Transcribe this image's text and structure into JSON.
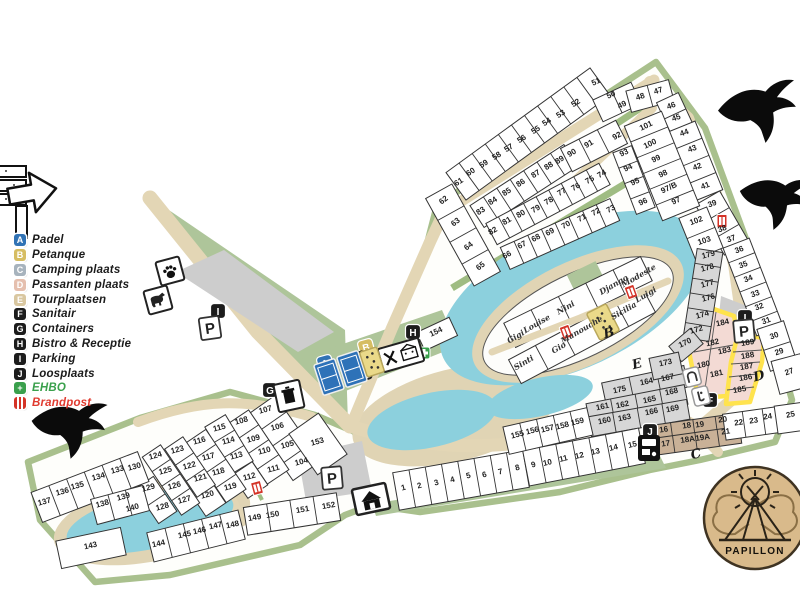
{
  "logo": {
    "text": "PAPILLON"
  },
  "legend": {
    "items": [
      {
        "letter": "A",
        "label": "Padel",
        "color": "#3173b5",
        "text_color": "#1b1b1b"
      },
      {
        "letter": "B",
        "label": "Petanque",
        "color": "#d6bd62",
        "text_color": "#1b1b1b"
      },
      {
        "letter": "C",
        "label": "Camping plaats",
        "color": "#a7b3bd",
        "text_color": "#1b1b1b"
      },
      {
        "letter": "D",
        "label": "Passanten plaats",
        "color": "#e5bfae",
        "text_color": "#1b1b1b"
      },
      {
        "letter": "E",
        "label": "Tourplaatsen",
        "color": "#d9c7a0",
        "text_color": "#1b1b1b"
      },
      {
        "letter": "F",
        "label": "Sanitair",
        "color": "#1c1c1c",
        "text_color": "#1b1b1b"
      },
      {
        "letter": "G",
        "label": "Containers",
        "color": "#1c1c1c",
        "text_color": "#1b1b1b"
      },
      {
        "letter": "H",
        "label": "Bistro & Receptie",
        "color": "#1c1c1c",
        "text_color": "#1b1b1b"
      },
      {
        "letter": "I",
        "label": "Parking",
        "color": "#1c1c1c",
        "text_color": "#1b1b1b"
      },
      {
        "letter": "J",
        "label": "Loosplaats",
        "color": "#1c1c1c",
        "text_color": "#1b1b1b"
      },
      {
        "letter": "+",
        "label": "EHBO",
        "color": "#3aa04c",
        "text_color": "#3aa04c"
      },
      {
        "letter": "",
        "label": "Brandpost",
        "color": "#d43327",
        "text_color": "#e03a2f",
        "type": "brandpost"
      }
    ]
  },
  "map": {
    "colors": {
      "water": "#8cd0dd",
      "path": "#e3d6b5",
      "green": "#aec59a",
      "border_green": "#a9c08d",
      "pink": "#f3dad4",
      "highlight_yellow": "#ffe34d",
      "brown": "#c9b197",
      "gray": "#d7d7d7"
    },
    "plots": [
      [
        "65",
        482,
        268,
        -38
      ],
      [
        "64",
        470,
        248,
        -38
      ],
      [
        "63",
        457,
        224,
        -38
      ],
      [
        "62",
        445,
        202,
        -38
      ],
      [
        "61",
        460,
        184,
        -33
      ],
      [
        "60",
        472,
        174,
        -33
      ],
      [
        "59",
        485,
        166,
        -33
      ],
      [
        "58",
        498,
        158,
        -33
      ],
      [
        "57",
        510,
        150,
        -33
      ],
      [
        "56",
        523,
        141,
        -33
      ],
      [
        "55",
        537,
        132,
        -33
      ],
      [
        "54",
        548,
        124,
        -33
      ],
      [
        "53",
        562,
        116,
        -33
      ],
      [
        "52",
        577,
        105,
        -33
      ],
      [
        "51",
        597,
        84,
        -25
      ],
      [
        "50",
        612,
        97,
        -25
      ],
      [
        "49",
        623,
        107,
        -25
      ],
      [
        "48",
        641,
        99,
        -18
      ],
      [
        "47",
        659,
        93,
        -18
      ],
      [
        "46",
        672,
        108,
        -20
      ],
      [
        "45",
        677,
        120,
        -20
      ],
      [
        "44",
        685,
        135,
        -20
      ],
      [
        "43",
        693,
        151,
        -20
      ],
      [
        "42",
        698,
        169,
        -20
      ],
      [
        "41",
        706,
        188,
        -20
      ],
      [
        "39",
        713,
        206,
        -20
      ],
      [
        "38",
        723,
        231,
        -20
      ],
      [
        "37",
        732,
        241,
        -20
      ],
      [
        "36",
        740,
        252,
        -20
      ],
      [
        "35",
        744,
        267,
        -20
      ],
      [
        "34",
        749,
        281,
        -20
      ],
      [
        "33",
        756,
        296,
        -20
      ],
      [
        "32",
        760,
        309,
        -20
      ],
      [
        "31",
        767,
        323,
        -20
      ],
      [
        "30",
        775,
        338,
        -20
      ],
      [
        "29",
        780,
        354,
        -20
      ],
      [
        "27",
        790,
        374,
        -20
      ],
      [
        "25",
        791,
        417,
        -12
      ],
      [
        "83",
        482,
        213,
        -33
      ],
      [
        "84",
        494,
        203,
        -33
      ],
      [
        "85",
        508,
        194,
        -33
      ],
      [
        "86",
        522,
        185,
        -33
      ],
      [
        "87",
        537,
        176,
        -33
      ],
      [
        "88",
        550,
        168,
        -33
      ],
      [
        "89",
        561,
        162,
        -33
      ],
      [
        "90",
        573,
        155,
        -30
      ],
      [
        "91",
        590,
        146,
        -30
      ],
      [
        "92",
        618,
        138,
        -28
      ],
      [
        "101",
        647,
        128,
        -25
      ],
      [
        "100",
        651,
        146,
        -25
      ],
      [
        "99",
        657,
        161,
        -25
      ],
      [
        "98",
        664,
        176,
        -25
      ],
      [
        "97/B",
        670,
        190,
        -25
      ],
      [
        "97",
        677,
        203,
        -25
      ],
      [
        "93",
        625,
        155,
        -25
      ],
      [
        "94",
        629,
        170,
        -25
      ],
      [
        "95",
        636,
        184,
        -25
      ],
      [
        "96",
        644,
        204,
        -25
      ],
      [
        "82",
        494,
        233,
        -30
      ],
      [
        "81",
        508,
        223,
        -30
      ],
      [
        "80",
        522,
        216,
        -30
      ],
      [
        "79",
        537,
        211,
        -30
      ],
      [
        "78",
        550,
        203,
        -30
      ],
      [
        "77",
        563,
        194,
        -30
      ],
      [
        "76",
        577,
        189,
        -30
      ],
      [
        "75",
        591,
        182,
        -30
      ],
      [
        "74",
        603,
        176,
        -30
      ],
      [
        "73",
        612,
        211,
        -28
      ],
      [
        "72",
        597,
        214,
        -28
      ],
      [
        "71",
        583,
        220,
        -28
      ],
      [
        "70",
        567,
        227,
        -28
      ],
      [
        "69",
        551,
        234,
        -28
      ],
      [
        "68",
        537,
        240,
        -28
      ],
      [
        "67",
        523,
        247,
        -28
      ],
      [
        "66",
        508,
        257,
        -28
      ],
      [
        "102",
        697,
        223,
        -20
      ],
      [
        "103",
        705,
        243,
        -18
      ],
      [
        "179",
        709,
        257,
        -15
      ],
      [
        "178",
        708,
        270,
        -15
      ],
      [
        "177",
        708,
        286,
        -15
      ],
      [
        "176",
        709,
        300,
        -15
      ],
      [
        "174",
        703,
        317,
        -15
      ],
      [
        "172",
        697,
        332,
        -15
      ],
      [
        "170",
        686,
        345,
        -25
      ],
      [
        "184",
        723,
        325,
        -12
      ],
      [
        "182",
        713,
        345,
        -12
      ],
      [
        "183",
        725,
        353,
        -12
      ],
      [
        "180",
        704,
        367,
        -12
      ],
      [
        "181",
        717,
        376,
        -12
      ],
      [
        "189",
        748,
        345,
        -10
      ],
      [
        "188",
        748,
        358,
        -10
      ],
      [
        "187",
        747,
        369,
        -10
      ],
      [
        "186",
        746,
        380,
        -10
      ],
      [
        "185",
        740,
        392,
        -10
      ],
      [
        "173",
        666,
        365,
        -12
      ],
      [
        "175",
        620,
        392,
        -12
      ],
      [
        "164",
        647,
        384,
        -12
      ],
      [
        "167",
        668,
        380,
        -12
      ],
      [
        "161",
        603,
        409,
        -12
      ],
      [
        "162",
        623,
        407,
        -12
      ],
      [
        "165",
        650,
        402,
        -12
      ],
      [
        "168",
        672,
        394,
        -12
      ],
      [
        "160",
        605,
        423,
        -12
      ],
      [
        "163",
        625,
        420,
        -12
      ],
      [
        "166",
        652,
        414,
        -12
      ],
      [
        "169",
        673,
        411,
        -12
      ],
      [
        "16",
        664,
        432,
        -8
      ],
      [
        "17",
        666,
        446,
        -8
      ],
      [
        "18",
        687,
        428,
        -8
      ],
      [
        "18A",
        688,
        442,
        -8
      ],
      [
        "19",
        700,
        427,
        -8
      ],
      [
        "19A",
        703,
        440,
        -8
      ],
      [
        "20",
        723,
        422,
        -8
      ],
      [
        "21",
        726,
        434,
        -8
      ],
      [
        "22",
        739,
        425,
        -8
      ],
      [
        "23",
        754,
        423,
        -8
      ],
      [
        "24",
        768,
        419,
        -8
      ],
      [
        "1",
        404,
        490,
        -15
      ],
      [
        "2",
        420,
        488,
        -15
      ],
      [
        "3",
        437,
        485,
        -15
      ],
      [
        "4",
        453,
        482,
        -15
      ],
      [
        "5",
        469,
        478,
        -15
      ],
      [
        "6",
        485,
        477,
        -15
      ],
      [
        "7",
        501,
        474,
        -15
      ],
      [
        "8",
        518,
        470,
        -15
      ],
      [
        "9",
        534,
        467,
        -15
      ],
      [
        "10",
        548,
        465,
        -13
      ],
      [
        "11",
        564,
        461,
        -13
      ],
      [
        "12",
        580,
        458,
        -13
      ],
      [
        "13",
        596,
        454,
        -13
      ],
      [
        "14",
        614,
        450,
        -13
      ],
      [
        "15",
        633,
        447,
        -13
      ],
      [
        "155",
        518,
        437,
        -14
      ],
      [
        "156",
        533,
        433,
        -14
      ],
      [
        "157",
        548,
        431,
        -14
      ],
      [
        "158",
        563,
        428,
        -14
      ],
      [
        "159",
        578,
        424,
        -14
      ],
      [
        "104",
        302,
        464,
        -15
      ],
      [
        "105",
        288,
        447,
        -15
      ],
      [
        "106",
        278,
        429,
        -15
      ],
      [
        "107",
        266,
        412,
        -15
      ],
      [
        "108",
        242,
        423,
        -15
      ],
      [
        "109",
        254,
        441,
        -15
      ],
      [
        "110",
        265,
        453,
        -15
      ],
      [
        "111",
        274,
        471,
        -15
      ],
      [
        "112",
        250,
        479,
        -15
      ],
      [
        "113",
        237,
        458,
        -15
      ],
      [
        "114",
        229,
        443,
        -15
      ],
      [
        "115",
        220,
        430,
        -15
      ],
      [
        "116",
        200,
        443,
        -15
      ],
      [
        "117",
        209,
        459,
        -15
      ],
      [
        "118",
        219,
        474,
        -15
      ],
      [
        "119",
        231,
        489,
        -15
      ],
      [
        "120",
        208,
        497,
        -15
      ],
      [
        "121",
        201,
        480,
        -15
      ],
      [
        "122",
        190,
        468,
        -15
      ],
      [
        "123",
        178,
        452,
        -15
      ],
      [
        "124",
        156,
        458,
        -15
      ],
      [
        "125",
        166,
        473,
        -15
      ],
      [
        "126",
        175,
        488,
        -15
      ],
      [
        "127",
        185,
        502,
        -15
      ],
      [
        "128",
        163,
        509,
        -15
      ],
      [
        "129",
        149,
        490,
        -15
      ],
      [
        "130",
        135,
        469,
        -15
      ],
      [
        "133",
        118,
        472,
        -15
      ],
      [
        "134",
        99,
        479,
        -15
      ],
      [
        "135",
        78,
        488,
        -15
      ],
      [
        "136",
        63,
        494,
        -15
      ],
      [
        "137",
        45,
        504,
        -15
      ],
      [
        "138",
        103,
        506,
        -15
      ],
      [
        "139",
        124,
        499,
        -15
      ],
      [
        "140",
        133,
        510,
        -15
      ],
      [
        "143",
        91,
        548,
        -12
      ],
      [
        "144",
        159,
        546,
        -12
      ],
      [
        "145",
        185,
        537,
        -12
      ],
      [
        "146",
        200,
        533,
        -12
      ],
      [
        "147",
        216,
        528,
        -12
      ],
      [
        "148",
        233,
        527,
        -12
      ],
      [
        "149",
        255,
        520,
        -10
      ],
      [
        "150",
        273,
        517,
        -10
      ],
      [
        "151",
        303,
        512,
        -10
      ],
      [
        "152",
        329,
        508,
        -10
      ],
      [
        "153",
        318,
        444,
        -15
      ],
      [
        "154",
        437,
        334,
        -25
      ]
    ],
    "island_names": [
      [
        "Gigi",
        517,
        339,
        -30
      ],
      [
        "Louise",
        538,
        326,
        -30
      ],
      [
        "Nini",
        567,
        310,
        -30
      ],
      [
        "Django",
        615,
        287,
        -30
      ],
      [
        "Modeste",
        640,
        278,
        -30
      ],
      [
        "Sinti",
        525,
        365,
        -30
      ],
      [
        "Gio",
        560,
        350,
        -30
      ],
      [
        "Manouche",
        583,
        332,
        -30
      ],
      [
        "Sicilia",
        625,
        313,
        -30
      ],
      [
        "Luigi",
        647,
        297,
        -30
      ]
    ],
    "zone_letters": [
      [
        "B",
        610,
        337
      ],
      [
        "E",
        638,
        368
      ],
      [
        "C",
        697,
        458
      ],
      [
        "D",
        760,
        380
      ]
    ],
    "icons": [
      [
        "badge-A",
        325,
        363,
        -15
      ],
      [
        "badge-B",
        366,
        347,
        -15
      ],
      [
        "badge-H",
        413,
        332,
        0
      ],
      [
        "badge-I",
        218,
        311,
        0
      ],
      [
        "badge-I",
        745,
        317,
        0
      ],
      [
        "badge-G",
        270,
        390,
        0
      ],
      [
        "badge-F",
        710,
        400,
        0
      ],
      [
        "badge-J",
        650,
        431,
        0
      ],
      [
        "psign",
        210,
        328,
        -8
      ],
      [
        "psign",
        744,
        331,
        -5
      ],
      [
        "psign",
        332,
        478,
        -5
      ],
      [
        "brand",
        722,
        221,
        0
      ],
      [
        "brand",
        566,
        332,
        -20
      ],
      [
        "brand",
        631,
        292,
        -20
      ],
      [
        "brand",
        257,
        488,
        -15
      ],
      [
        "ehbo",
        424,
        353,
        0
      ],
      [
        "paw",
        170,
        271,
        -15
      ],
      [
        "dog",
        158,
        300,
        -15
      ],
      [
        "trash",
        289,
        396,
        -12
      ],
      [
        "net",
        359,
        367,
        -18
      ],
      [
        "bistro",
        401,
        355,
        -16
      ],
      [
        "house",
        371,
        499,
        -12
      ],
      [
        "wash1",
        692,
        377,
        -14
      ],
      [
        "wash2",
        701,
        396,
        -14
      ],
      [
        "dump",
        649,
        448,
        0
      ],
      [
        "courtb",
        329,
        377,
        -18
      ],
      [
        "courtb",
        352,
        369,
        -18
      ],
      [
        "courty",
        372,
        362,
        -18
      ],
      [
        "courty2",
        603,
        322,
        -27
      ]
    ]
  }
}
